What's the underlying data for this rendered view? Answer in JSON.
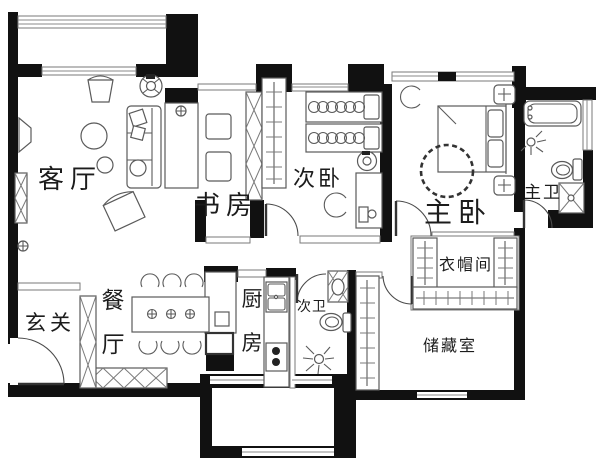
{
  "colors": {
    "wall": "#111111",
    "thin_wall_line": "#7a7a7a",
    "furniture_line": "#5a5a5a",
    "text": "#1c1c1c",
    "background": "#ffffff"
  },
  "rooms": {
    "living": {
      "label": "客厅"
    },
    "study": {
      "label": "书房"
    },
    "bedroom2": {
      "label": "次卧"
    },
    "master": {
      "label": "主卧"
    },
    "master_bath": {
      "label": "主卫"
    },
    "closet": {
      "label": "衣帽间"
    },
    "storage": {
      "label": "储藏室"
    },
    "bath2": {
      "label": "次卫"
    },
    "kitchen": {
      "label": "厨房",
      "char1": "厨",
      "char2": "房"
    },
    "dining": {
      "label": "餐厅",
      "char1": "餐",
      "char2": "厅"
    },
    "entry": {
      "label": "玄关"
    }
  }
}
